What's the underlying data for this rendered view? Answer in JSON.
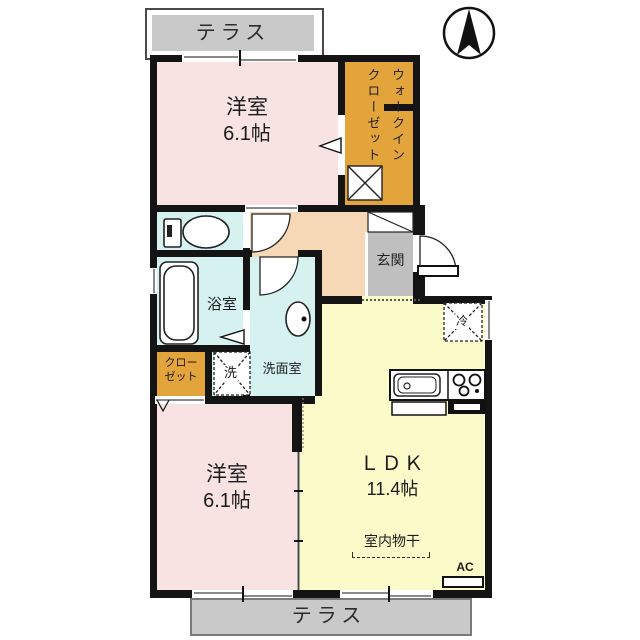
{
  "terraces": {
    "top": "テラス",
    "bottom": "テラス"
  },
  "rooms": {
    "bedroom_top": {
      "name": "洋室",
      "size": "6.1帖"
    },
    "walk_in_closet": {
      "name": "ウォークインクローゼット"
    },
    "entrance": {
      "name": "玄関"
    },
    "bathroom": {
      "name": "浴室"
    },
    "washroom": {
      "name": "洗面室"
    },
    "closet": {
      "line1": "クロー",
      "line2": "ゼット"
    },
    "bedroom_bottom": {
      "name": "洋室",
      "size": "6.1帖"
    },
    "ldk": {
      "name": "ＬＤＫ",
      "size": "11.4帖"
    }
  },
  "fixtures": {
    "washer": "洗",
    "refrigerator": "冷",
    "indoor_drying": "室内物干",
    "air_conditioner": "AC"
  },
  "compass": {
    "direction": "N"
  },
  "colors": {
    "bedroom": "#F8E2E2",
    "closet": "#E4A43C",
    "wet_area": "#D6F2F0",
    "hallway": "#F6D8B7",
    "ldk": "#FBFBC9",
    "terrace": "#C9C9C9",
    "entrance_floor": "#BFBFBF",
    "wall": "#141414"
  }
}
